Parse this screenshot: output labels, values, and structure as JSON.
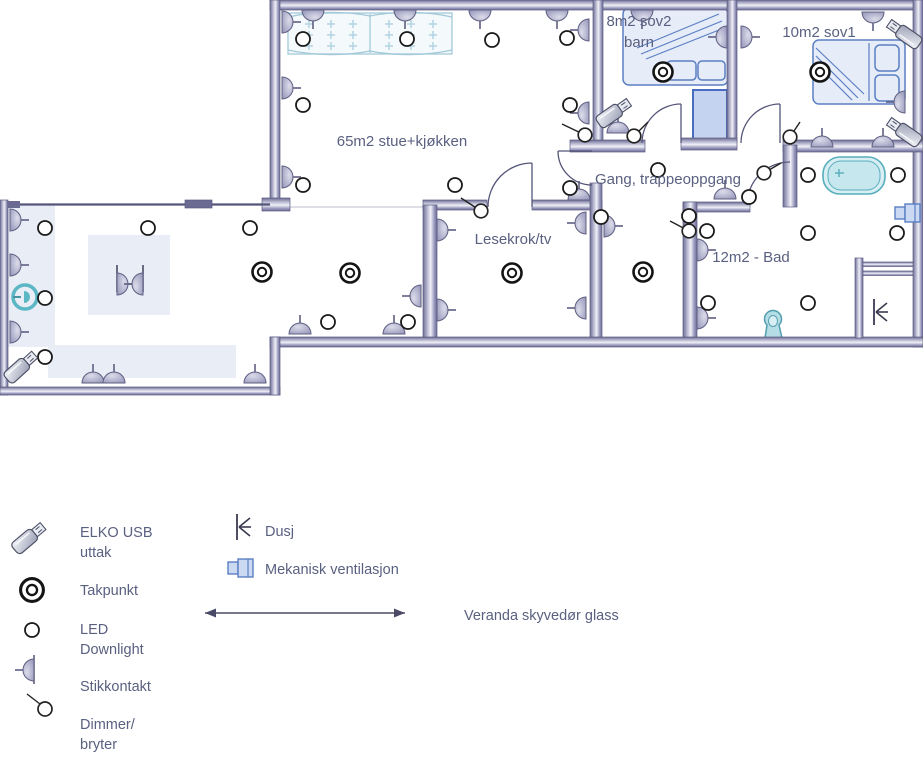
{
  "colors": {
    "wall": "#8585ad",
    "text": "#5a6080",
    "furniture_stroke": "#5b7fc4",
    "furniture_fill": "#e6ecf8",
    "fixture": "#57aebc",
    "vent_fill": "#ccd9f2",
    "cabinet_stroke": "#a3c9d9"
  },
  "rooms": {
    "stue": {
      "label": "65m2 stue+kjøkken"
    },
    "sov2": {
      "lines": [
        "8m2 sov2",
        "barn"
      ]
    },
    "sov1": {
      "label": "10m2 sov1"
    },
    "gang": {
      "label": "Gang, trappeoppgang"
    },
    "lesekrok": {
      "label": "Lesekrok/tv"
    },
    "bad": {
      "label": "12m2 - Bad"
    }
  },
  "legend": {
    "items": [
      {
        "symbol": "elko-usb-icon",
        "lines": [
          "ELKO USB",
          "uttak"
        ]
      },
      {
        "symbol": "takpunkt-icon",
        "lines": [
          "Takpunkt"
        ]
      },
      {
        "symbol": "led-downlight-icon",
        "lines": [
          "LED",
          "Downlight"
        ]
      },
      {
        "symbol": "stikkontakt-icon",
        "lines": [
          "Stikkontakt"
        ]
      },
      {
        "symbol": "dimmer-icon",
        "lines": [
          "Dimmer/",
          "bryter"
        ]
      },
      {
        "symbol": "dusj-icon",
        "lines": [
          "Dusj"
        ]
      },
      {
        "symbol": "ventilasjon-icon",
        "lines": [
          "Mekanisk ventilasjon"
        ]
      },
      {
        "symbol": "veranda-line-icon",
        "lines": [
          "Veranda skyvedør glass"
        ]
      }
    ]
  },
  "plan": {
    "symbols": {
      "takpunkt": [
        [
          262,
          272
        ],
        [
          350,
          273
        ],
        [
          512,
          273
        ],
        [
          643,
          272
        ],
        [
          663,
          72
        ],
        [
          820,
          72
        ]
      ],
      "led": [
        [
          303,
          39
        ],
        [
          407,
          39
        ],
        [
          492,
          40
        ],
        [
          567,
          38
        ],
        [
          303,
          105
        ],
        [
          570,
          105
        ],
        [
          303,
          185
        ],
        [
          455,
          185
        ],
        [
          570,
          188
        ],
        [
          601,
          217
        ],
        [
          658,
          170
        ],
        [
          328,
          322
        ],
        [
          408,
          322
        ],
        [
          45,
          228
        ],
        [
          148,
          228
        ],
        [
          250,
          228
        ],
        [
          45,
          298
        ],
        [
          45,
          357
        ],
        [
          689,
          216
        ],
        [
          749,
          197
        ],
        [
          808,
          175
        ],
        [
          898,
          175
        ],
        [
          808,
          233
        ],
        [
          897,
          233
        ],
        [
          707,
          231
        ],
        [
          708,
          303
        ],
        [
          808,
          303
        ]
      ],
      "stik": [
        [
          313,
          10,
          "d"
        ],
        [
          405,
          10,
          "d"
        ],
        [
          480,
          10,
          "d"
        ],
        [
          557,
          10,
          "d"
        ],
        [
          642,
          10,
          "d"
        ],
        [
          873,
          12,
          "d"
        ],
        [
          282,
          22,
          "r"
        ],
        [
          282,
          88,
          "r"
        ],
        [
          282,
          177,
          "r"
        ],
        [
          10,
          220,
          "r"
        ],
        [
          10,
          265,
          "r"
        ],
        [
          10,
          332,
          "r"
        ],
        [
          437,
          230,
          "r"
        ],
        [
          437,
          310,
          "r"
        ],
        [
          604,
          226,
          "r"
        ],
        [
          697,
          250,
          "r"
        ],
        [
          697,
          318,
          "r"
        ],
        [
          741,
          37,
          "r"
        ],
        [
          117,
          284,
          "r"
        ],
        [
          589,
          30,
          "l"
        ],
        [
          589,
          113,
          "l"
        ],
        [
          421,
          296,
          "l"
        ],
        [
          586,
          223,
          "l"
        ],
        [
          586,
          308,
          "l"
        ],
        [
          905,
          102,
          "l"
        ],
        [
          727,
          37,
          "l"
        ],
        [
          143,
          284,
          "l"
        ],
        [
          93,
          383,
          "u"
        ],
        [
          114,
          383,
          "u"
        ],
        [
          255,
          383,
          "u"
        ],
        [
          300,
          334,
          "u"
        ],
        [
          394,
          334,
          "u"
        ],
        [
          618,
          133,
          "u"
        ],
        [
          822,
          147,
          "u"
        ],
        [
          883,
          147,
          "u"
        ],
        [
          725,
          199,
          "u"
        ],
        [
          579,
          200,
          "u"
        ]
      ],
      "dimmer": [
        {
          "c": [
            585,
            135
          ],
          "l": [
            562,
            124
          ]
        },
        {
          "c": [
            634,
            136
          ],
          "l": [
            648,
            122
          ]
        },
        {
          "c": [
            790,
            137
          ],
          "l": [
            800,
            122
          ]
        },
        {
          "c": [
            481,
            211
          ],
          "l": [
            461,
            198
          ]
        },
        {
          "c": [
            689,
            231
          ],
          "l": [
            670,
            221
          ]
        },
        {
          "c": [
            764,
            173
          ],
          "l": [
            781,
            163
          ]
        }
      ],
      "usb": [
        [
          22,
          366,
          -42
        ],
        [
          615,
          112,
          -35
        ],
        [
          903,
          33,
          215
        ],
        [
          903,
          131,
          215
        ]
      ],
      "dusj": [
        [
          874,
          312
        ]
      ],
      "vent": [
        [
          908,
          213
        ]
      ]
    },
    "kitchen": {
      "cols": [
        309,
        331,
        353,
        389,
        411,
        433
      ],
      "rows": [
        24,
        35,
        46
      ],
      "size": 4
    }
  }
}
